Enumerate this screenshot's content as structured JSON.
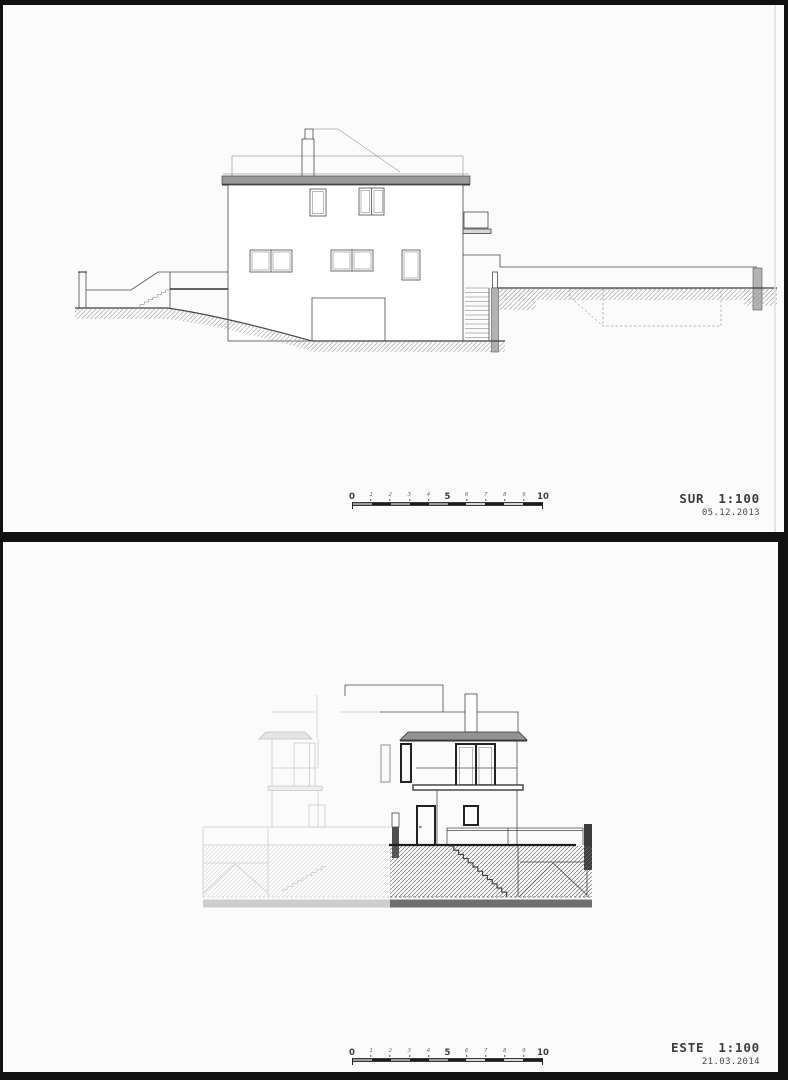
{
  "colors": {
    "frame": "#111111",
    "paper": "#fbfbfb",
    "line": "#4a4a4a",
    "dark_line": "#222222",
    "faded_line": "#c8cbce",
    "cornice_fill": "#9a9a9a",
    "post_fill": "#b3b3b3",
    "text": "#3b3b3b",
    "bar_dark": "#1c1c1c",
    "bar_gray": "#9b9b9b",
    "bar_light": "#d4d4d4"
  },
  "panels": [
    {
      "id": "sur",
      "title": "SUR",
      "scale": "1:100",
      "date": "05.12.2013"
    },
    {
      "id": "este",
      "title": "ESTE",
      "scale": "1:100",
      "date": "21.03.2014"
    }
  ],
  "scalebar": {
    "labels": [
      "0",
      "1",
      "2",
      "3",
      "4",
      "5",
      "6",
      "7",
      "8",
      "9",
      "10"
    ]
  }
}
